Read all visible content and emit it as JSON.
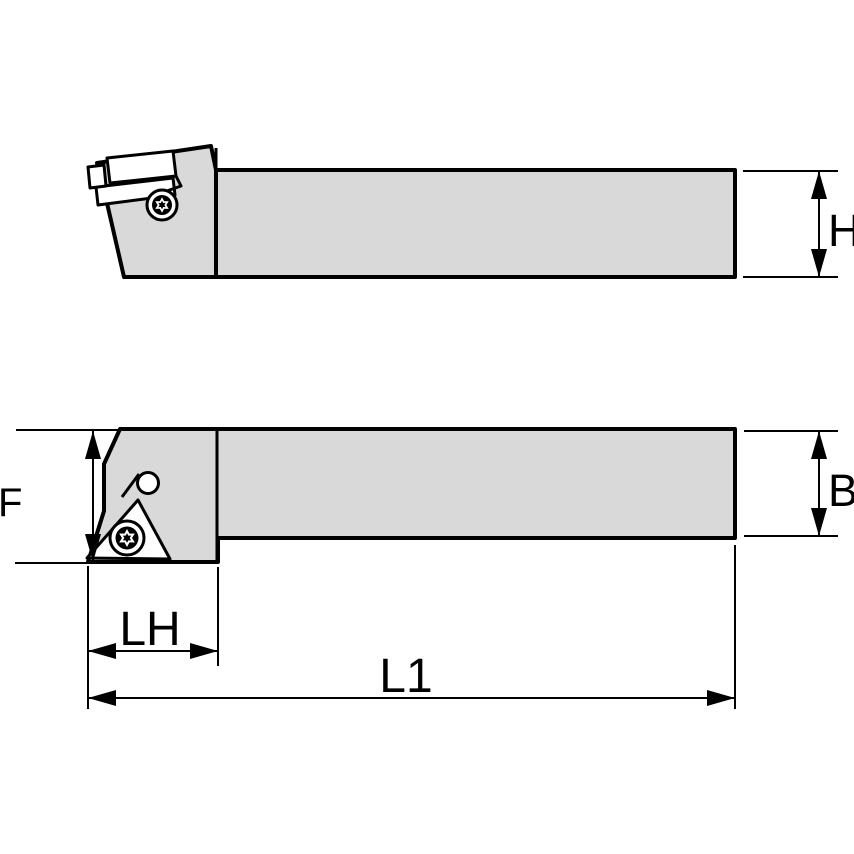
{
  "drawing": {
    "background": "#ffffff",
    "body_fill": "#d9d9d9",
    "line_color": "#000000",
    "views": [
      {
        "id": "side-view",
        "content": "toolholder shank with clamp head, insert and torx screw"
      },
      {
        "id": "plan-view",
        "content": "toolholder shank with offset head, triangular insert, pin and torx screw"
      }
    ],
    "dimension_labels": {
      "h": "H",
      "b": "B",
      "f": "F",
      "lh": "LH",
      "l1": "L1"
    }
  }
}
